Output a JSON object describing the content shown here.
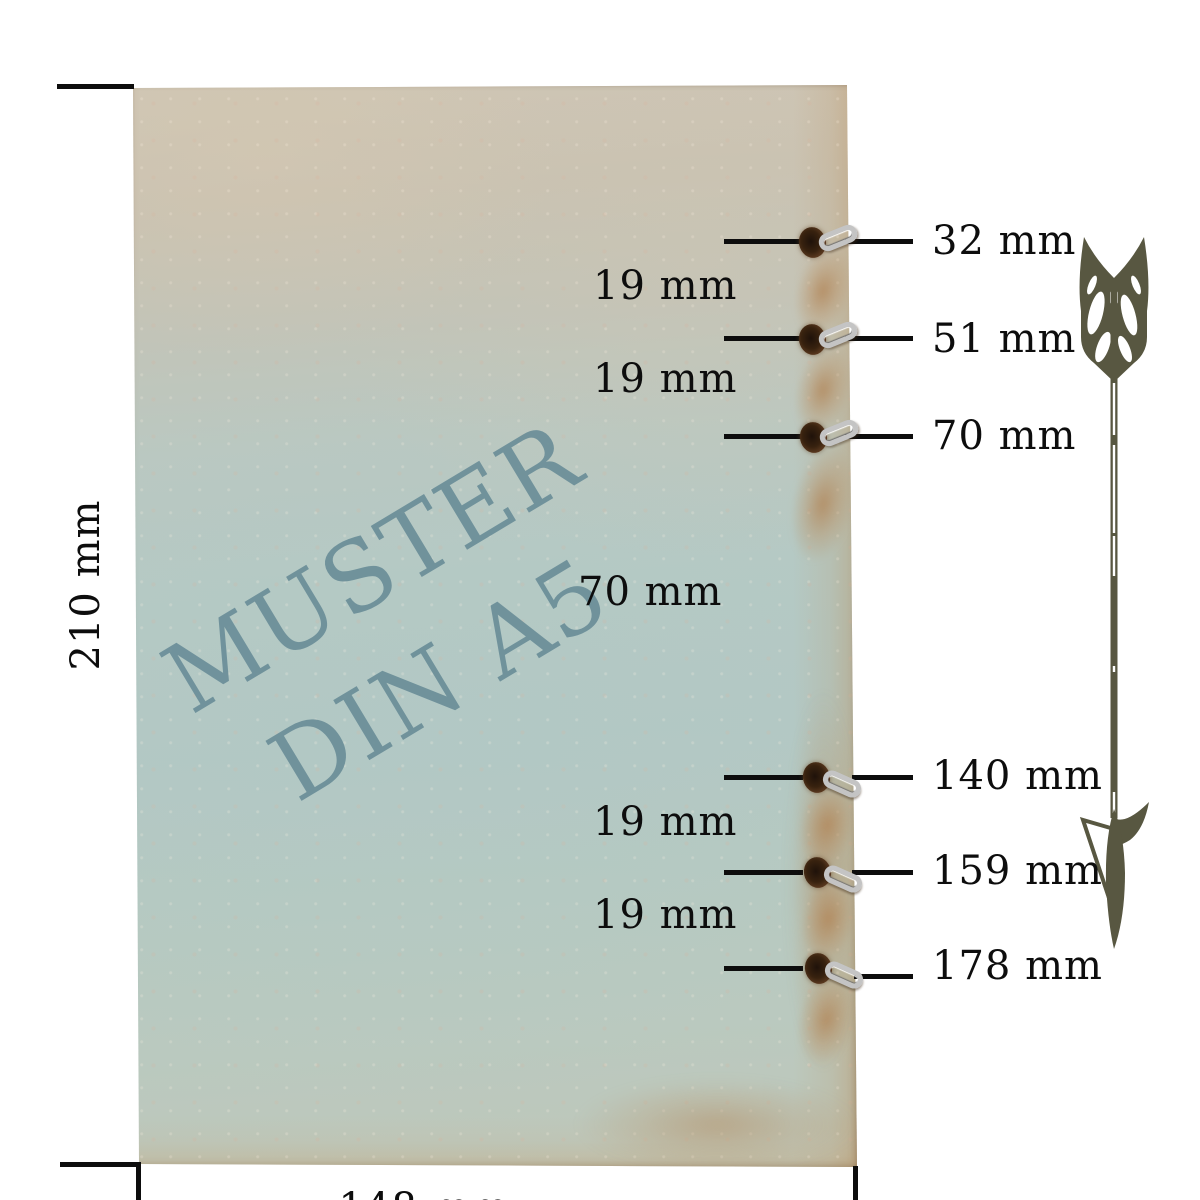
{
  "watermark": {
    "line1": "MUSTER",
    "line2": "DIN A5"
  },
  "dimensions": {
    "height_label": "210 mm",
    "width_label": "148 mm"
  },
  "holes": [
    {
      "label": "32 mm"
    },
    {
      "label": "51 mm"
    },
    {
      "label": "70 mm"
    },
    {
      "label": "140 mm"
    },
    {
      "label": "159 mm"
    },
    {
      "label": "178 mm"
    }
  ],
  "gaps": [
    {
      "label": "19 mm"
    },
    {
      "label": "19 mm"
    },
    {
      "label": "70 mm"
    },
    {
      "label": "19 mm"
    },
    {
      "label": "19 mm"
    }
  ],
  "icons": {
    "arrow": "down-arrow"
  },
  "colors": {
    "annotation": "#0d0d0d",
    "arrow": "#585741",
    "watermark_text": "#6b8e98",
    "paper_beige": "#cfc6b5",
    "paper_blue": "#b4c8c3",
    "paper_tan_edge": "#bb9464",
    "ring_metal": "#c4c4c4",
    "hole_brown": "#38220f"
  }
}
